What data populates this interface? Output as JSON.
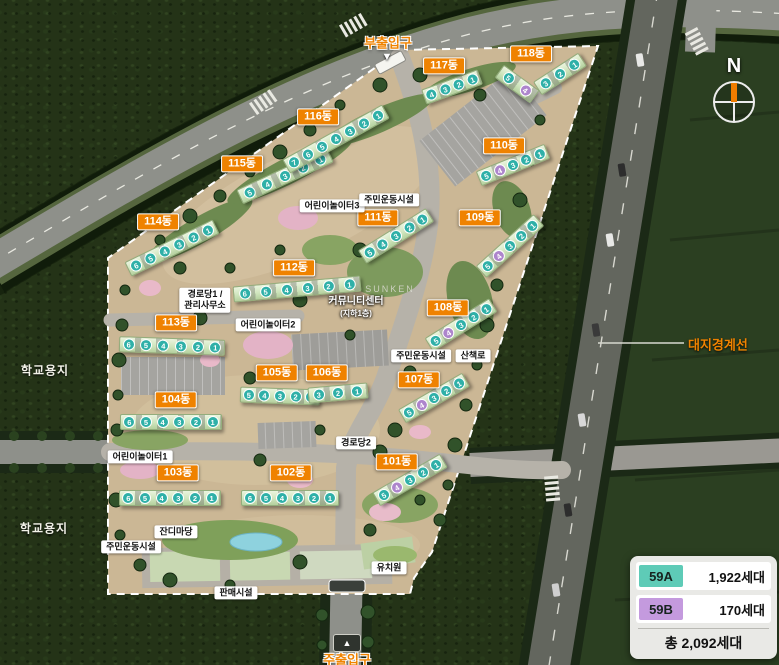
{
  "map": {
    "compass_label": "N",
    "boundary_label": "대지경계선",
    "school_sites": [
      {
        "label": "학교용지",
        "x": 45,
        "y": 370
      },
      {
        "label": "학교용지",
        "x": 44,
        "y": 528
      }
    ],
    "entrances": [
      {
        "label": "부출입구",
        "x": 388,
        "y": 42,
        "arrow": "down",
        "ax": 387,
        "ay": 57
      },
      {
        "label": "주출입구",
        "x": 347,
        "y": 659,
        "arrow": "upbox",
        "ax": 347,
        "ay": 643
      }
    ],
    "facilities": [
      {
        "label": "어린이놀이터3",
        "x": 332,
        "y": 206,
        "kind": "box"
      },
      {
        "label": "주민운동시설",
        "x": 389,
        "y": 200,
        "kind": "box"
      },
      {
        "label": "경로당1 /",
        "label2": "관리사무소",
        "x": 205,
        "y": 300,
        "kind": "box"
      },
      {
        "label": "커뮤니티센터",
        "label2": "(지하1층)",
        "x": 356,
        "y": 307,
        "kind": "text"
      },
      {
        "label": "SUNKEN",
        "x": 390,
        "y": 289,
        "kind": "gray"
      },
      {
        "label": "어린이놀이터2",
        "x": 268,
        "y": 325,
        "kind": "box"
      },
      {
        "label": "주민운동시설",
        "x": 421,
        "y": 356,
        "kind": "box"
      },
      {
        "label": "산책로",
        "x": 473,
        "y": 356,
        "kind": "box"
      },
      {
        "label": "경로당2",
        "x": 356,
        "y": 443,
        "kind": "box"
      },
      {
        "label": "어린이놀이터1",
        "x": 140,
        "y": 457,
        "kind": "box"
      },
      {
        "label": "잔디마당",
        "x": 176,
        "y": 532,
        "kind": "box"
      },
      {
        "label": "주민운동시설",
        "x": 131,
        "y": 547,
        "kind": "box"
      },
      {
        "label": "판매시설",
        "x": 236,
        "y": 593,
        "kind": "box"
      },
      {
        "label": "유치원",
        "x": 389,
        "y": 568,
        "kind": "box"
      }
    ],
    "buildings": [
      {
        "label": "101동",
        "lx": 397,
        "ly": 462,
        "strips": [
          {
            "x": 410,
            "y": 480,
            "len": 76,
            "angle": -30,
            "units": [
              {
                "n": 5
              },
              {
                "n": 4,
                "b": true
              },
              {
                "n": 3
              },
              {
                "n": 2
              },
              {
                "n": 1
              }
            ]
          }
        ]
      },
      {
        "label": "102동",
        "lx": 291,
        "ly": 473,
        "strips": [
          {
            "x": 290,
            "y": 498,
            "len": 96,
            "angle": 0,
            "units": [
              {
                "n": 6
              },
              {
                "n": 5
              },
              {
                "n": 4
              },
              {
                "n": 3
              },
              {
                "n": 2
              },
              {
                "n": 1
              }
            ]
          }
        ]
      },
      {
        "label": "103동",
        "lx": 178,
        "ly": 473,
        "strips": [
          {
            "x": 170,
            "y": 498,
            "len": 100,
            "angle": 0,
            "units": [
              {
                "n": 6
              },
              {
                "n": 5
              },
              {
                "n": 4
              },
              {
                "n": 3
              },
              {
                "n": 2
              },
              {
                "n": 1
              }
            ]
          }
        ]
      },
      {
        "label": "104동",
        "lx": 176,
        "ly": 400,
        "strips": [
          {
            "x": 171,
            "y": 422,
            "len": 100,
            "angle": 0,
            "units": [
              {
                "n": 6
              },
              {
                "n": 5
              },
              {
                "n": 4
              },
              {
                "n": 3
              },
              {
                "n": 2
              },
              {
                "n": 1
              }
            ]
          }
        ]
      },
      {
        "label": "105동",
        "lx": 277,
        "ly": 373,
        "strips": [
          {
            "x": 280,
            "y": 396,
            "len": 78,
            "angle": 2,
            "units": [
              {
                "n": 5
              },
              {
                "n": 4
              },
              {
                "n": 3
              },
              {
                "n": 2
              },
              {
                "n": 1
              }
            ]
          }
        ]
      },
      {
        "label": "106동",
        "lx": 327,
        "ly": 373,
        "strips": [
          {
            "x": 338,
            "y": 393,
            "len": 58,
            "angle": -5,
            "units": [
              {
                "n": 3
              },
              {
                "n": 2
              },
              {
                "n": 1
              }
            ]
          }
        ]
      },
      {
        "label": "107동",
        "lx": 419,
        "ly": 380,
        "strips": [
          {
            "x": 434,
            "y": 398,
            "len": 72,
            "angle": -30,
            "units": [
              {
                "n": 5
              },
              {
                "n": 4,
                "b": true
              },
              {
                "n": 3
              },
              {
                "n": 2
              },
              {
                "n": 1
              }
            ]
          }
        ]
      },
      {
        "label": "108동",
        "lx": 448,
        "ly": 308,
        "strips": [
          {
            "x": 461,
            "y": 325,
            "len": 74,
            "angle": -32,
            "units": [
              {
                "n": 5
              },
              {
                "n": 4,
                "b": true
              },
              {
                "n": 3
              },
              {
                "n": 2
              },
              {
                "n": 1
              }
            ]
          }
        ]
      },
      {
        "label": "109동",
        "lx": 480,
        "ly": 218,
        "strips": [
          {
            "x": 510,
            "y": 246,
            "len": 76,
            "angle": -42,
            "units": [
              {
                "n": 5
              },
              {
                "n": 4,
                "b": true
              },
              {
                "n": 3
              },
              {
                "n": 2
              },
              {
                "n": 1
              }
            ]
          }
        ]
      },
      {
        "label": "110동",
        "lx": 504,
        "ly": 146,
        "strips": [
          {
            "x": 513,
            "y": 165,
            "len": 72,
            "angle": -22,
            "units": [
              {
                "n": 5
              },
              {
                "n": 4,
                "b": true
              },
              {
                "n": 3
              },
              {
                "n": 2
              },
              {
                "n": 1
              }
            ]
          }
        ]
      },
      {
        "label": "111동",
        "lx": 378,
        "ly": 218,
        "strips": [
          {
            "x": 396,
            "y": 236,
            "len": 78,
            "angle": -32,
            "units": [
              {
                "n": 5
              },
              {
                "n": 4
              },
              {
                "n": 3
              },
              {
                "n": 2
              },
              {
                "n": 1
              }
            ]
          }
        ]
      },
      {
        "label": "112동",
        "lx": 294,
        "ly": 268,
        "strips": [
          {
            "x": 297,
            "y": 289,
            "len": 126,
            "angle": -5,
            "units": [
              {
                "n": 6
              },
              {
                "n": 5
              },
              {
                "n": 4
              },
              {
                "n": 3
              },
              {
                "n": 2
              },
              {
                "n": 1
              }
            ]
          }
        ]
      },
      {
        "label": "113동",
        "lx": 176,
        "ly": 323,
        "strips": [
          {
            "x": 172,
            "y": 346,
            "len": 104,
            "angle": 2,
            "units": [
              {
                "n": 6
              },
              {
                "n": 5
              },
              {
                "n": 4
              },
              {
                "n": 3
              },
              {
                "n": 2
              },
              {
                "n": 1
              }
            ]
          }
        ]
      },
      {
        "label": "114동",
        "lx": 158,
        "ly": 222,
        "strips": [
          {
            "x": 172,
            "y": 248,
            "len": 96,
            "angle": -26,
            "units": [
              {
                "n": 6
              },
              {
                "n": 5
              },
              {
                "n": 4
              },
              {
                "n": 3
              },
              {
                "n": 2
              },
              {
                "n": 1
              }
            ]
          }
        ]
      },
      {
        "label": "115동",
        "lx": 242,
        "ly": 164,
        "strips": [
          {
            "x": 285,
            "y": 176,
            "len": 98,
            "angle": -25,
            "units": [
              {
                "n": 5
              },
              {
                "n": 4
              },
              {
                "n": 3
              },
              {
                "n": 2
              },
              {
                "n": 1
              }
            ]
          }
        ]
      },
      {
        "label": "116동",
        "lx": 318,
        "ly": 117,
        "strips": [
          {
            "x": 336,
            "y": 139,
            "len": 112,
            "angle": -29,
            "units": [
              {
                "n": 7
              },
              {
                "n": 6
              },
              {
                "n": 5
              },
              {
                "n": 4
              },
              {
                "n": 3
              },
              {
                "n": 2
              },
              {
                "n": 1
              }
            ]
          }
        ]
      },
      {
        "label": "117동",
        "lx": 444,
        "ly": 66,
        "strips": [
          {
            "x": 452,
            "y": 87,
            "len": 58,
            "angle": -20,
            "units": [
              {
                "n": 4
              },
              {
                "n": 3
              },
              {
                "n": 2
              },
              {
                "n": 1
              }
            ]
          }
        ]
      },
      {
        "label": "118동",
        "lx": 531,
        "ly": 54,
        "strips": [
          {
            "x": 560,
            "y": 74,
            "len": 52,
            "angle": -33,
            "units": [
              {
                "n": 3
              },
              {
                "n": 2
              },
              {
                "n": 1
              }
            ]
          },
          {
            "x": 517,
            "y": 84,
            "len": 42,
            "angle": 36,
            "units": [
              {
                "n": 5
              },
              {
                "n": 4,
                "b": true
              }
            ]
          }
        ]
      }
    ]
  },
  "legend": {
    "rows": [
      {
        "code": "59A",
        "value": "1,922세대",
        "color": "#5ecbb7"
      },
      {
        "code": "59B",
        "value": "170세대",
        "color": "#c49ade"
      }
    ],
    "total": "총 2,092세대"
  },
  "colors": {
    "building_label_bg": "#ef8200",
    "unit_59a": "#2fb0a8",
    "unit_59b": "#ad85cc",
    "boundary_line": "#ffffff"
  }
}
